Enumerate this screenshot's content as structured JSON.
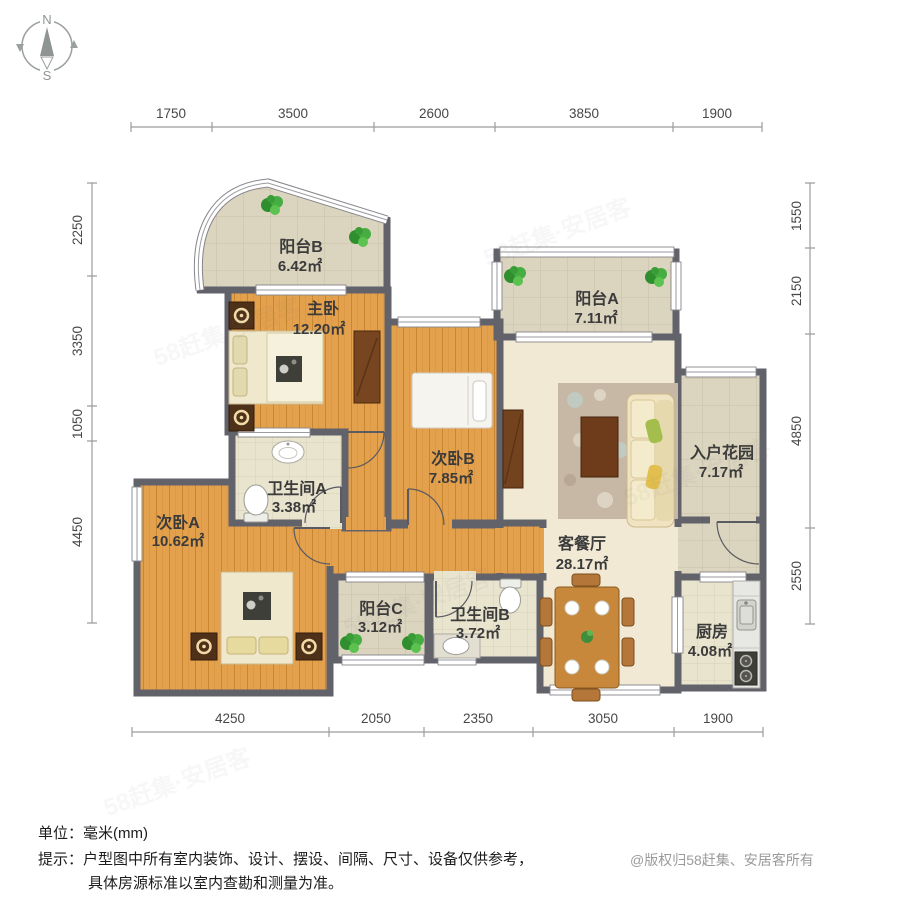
{
  "compass": {
    "north": "N",
    "south": "S"
  },
  "dimensions": {
    "top": [
      "1750",
      "3500",
      "2600",
      "3850",
      "1900"
    ],
    "bottom": [
      "4250",
      "2050",
      "2350",
      "3050",
      "1900"
    ],
    "left": [
      "2250",
      "3350",
      "1050",
      "4450"
    ],
    "right": [
      "1550",
      "2150",
      "4850",
      "2550"
    ]
  },
  "rooms": {
    "balcony_b": {
      "name": "阳台B",
      "area": "6.42㎡"
    },
    "master": {
      "name": "主卧",
      "area": "12.20㎡"
    },
    "balcony_a": {
      "name": "阳台A",
      "area": "7.11㎡"
    },
    "bedroom_b": {
      "name": "次卧B",
      "area": "7.85㎡"
    },
    "entry_garden": {
      "name": "入户花园",
      "area": "7.17㎡"
    },
    "bath_a": {
      "name": "卫生间A",
      "area": "3.38㎡"
    },
    "bedroom_a": {
      "name": "次卧A",
      "area": "10.62㎡"
    },
    "living_dining": {
      "name": "客餐厅",
      "area": "28.17㎡"
    },
    "balcony_c": {
      "name": "阳台C",
      "area": "3.12㎡"
    },
    "bath_b": {
      "name": "卫生间B",
      "area": "3.72㎡"
    },
    "kitchen": {
      "name": "厨房",
      "area": "4.08㎡"
    }
  },
  "footer": {
    "unit": "单位：毫米(mm)",
    "tip_line1": "提示：户型图中所有室内装饰、设计、摆设、间隔、尺寸、设备仅供参考，",
    "tip_line2": "具体房源标准以室内查勘和测量为准。",
    "copyright": "@版权归58赶集、安居客所有"
  },
  "watermark": {
    "text": "58赶集·安居客"
  },
  "colors": {
    "wall": "#62626B",
    "wood_floor": "#E3A04D",
    "tile_floor": "#DBD4BE",
    "bath_floor": "#E9E4CE",
    "living_floor": "#F2E9D5",
    "label_text": "#3B3B3B"
  }
}
